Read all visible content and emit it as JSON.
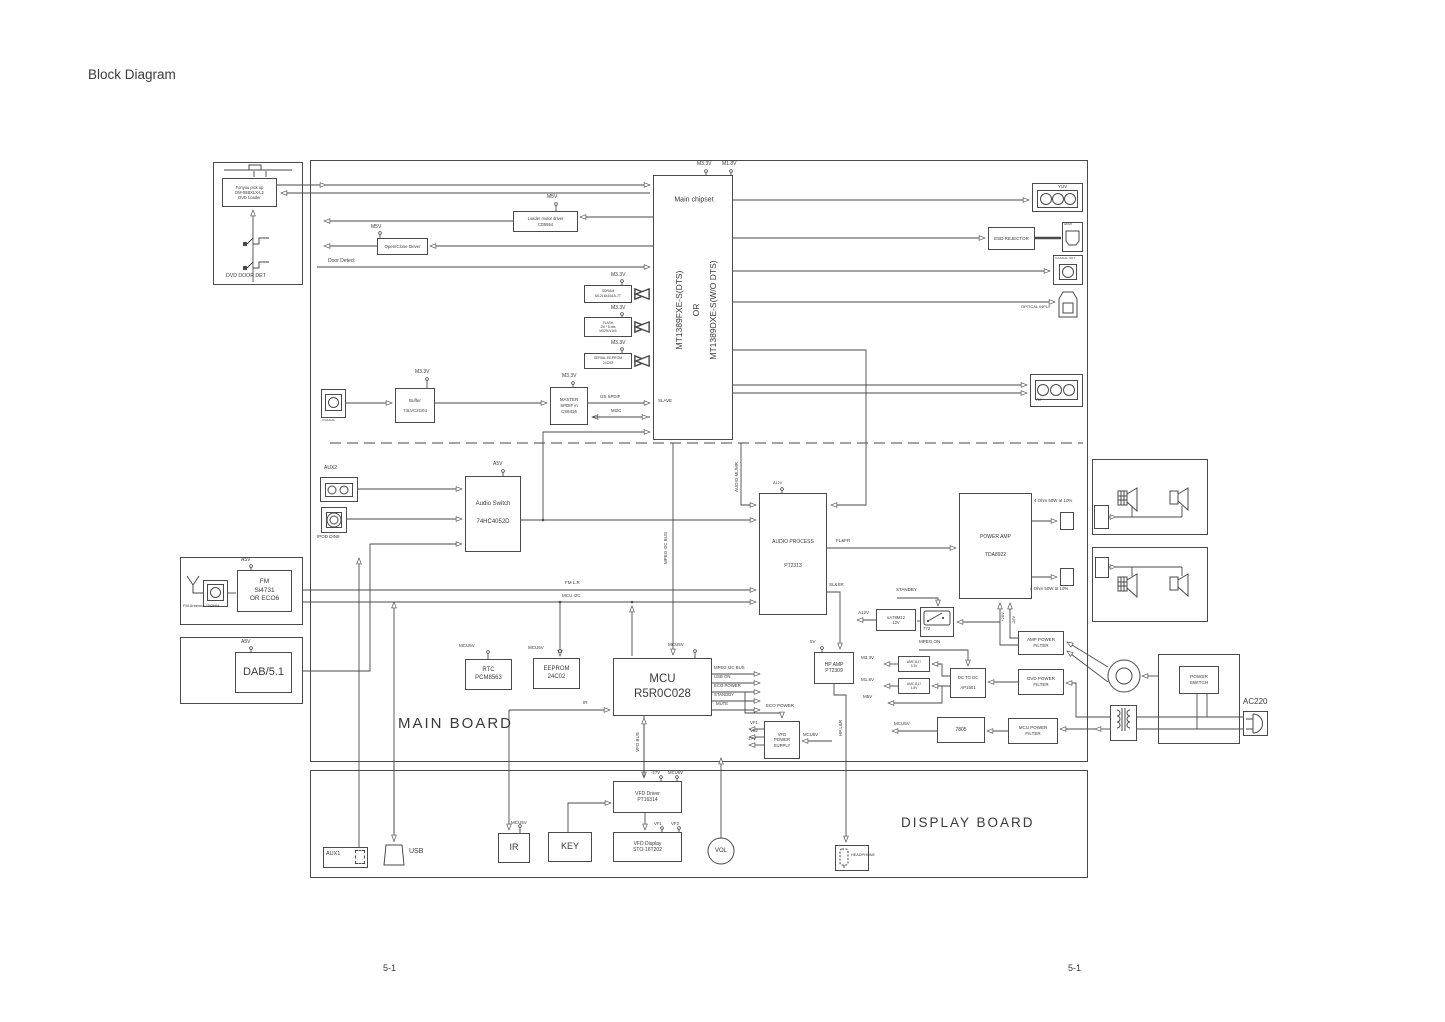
{
  "page": {
    "title": "Block Diagram",
    "footer_left": "5-1",
    "footer_right": "5-1"
  },
  "outlines": [
    {
      "n": "dvd-loader-assembly",
      "x": 213,
      "y": 162,
      "w": 90,
      "h": 123
    },
    {
      "n": "main-board",
      "x": 310,
      "y": 160,
      "w": 778,
      "h": 602
    },
    {
      "n": "display-board",
      "x": 310,
      "y": 770,
      "w": 778,
      "h": 108
    },
    {
      "n": "main-chipset-box",
      "x": 653,
      "y": 175,
      "w": 80,
      "h": 265
    },
    {
      "n": "fm-module-box",
      "x": 180,
      "y": 557,
      "w": 123,
      "h": 68
    },
    {
      "n": "dab-module-box",
      "x": 180,
      "y": 637,
      "w": 123,
      "h": 67
    },
    {
      "n": "speaker-box-1",
      "x": 1092,
      "y": 459,
      "w": 116,
      "h": 76
    },
    {
      "n": "speaker-box-2",
      "x": 1092,
      "y": 547,
      "w": 116,
      "h": 75
    },
    {
      "n": "power-supply-box",
      "x": 1158,
      "y": 654,
      "w": 82,
      "h": 90
    },
    {
      "n": "relay-772-box",
      "x": 920,
      "y": 607,
      "w": 34,
      "h": 30
    },
    {
      "n": "yuv-connector",
      "x": 1032,
      "y": 183,
      "w": 51,
      "h": 29
    },
    {
      "n": "yuv-connector-inner",
      "x": 1037,
      "y": 190,
      "w": 41,
      "h": 18
    },
    {
      "n": "av-connector",
      "x": 1030,
      "y": 374,
      "w": 53,
      "h": 33
    },
    {
      "n": "av-connector-inner",
      "x": 1035,
      "y": 380,
      "w": 43,
      "h": 20
    },
    {
      "n": "aux2-connector",
      "x": 320,
      "y": 477,
      "w": 38,
      "h": 25
    },
    {
      "n": "aux2-connector-inner",
      "x": 325,
      "y": 483,
      "w": 28,
      "h": 14
    },
    {
      "n": "ipod-connector",
      "x": 321,
      "y": 507,
      "w": 26,
      "h": 26
    },
    {
      "n": "ipod-connector-inner",
      "x": 326,
      "y": 512,
      "w": 16,
      "h": 16
    },
    {
      "n": "coaxial-in-connector",
      "x": 321,
      "y": 389,
      "w": 25,
      "h": 29
    },
    {
      "n": "coaxial-in-inner",
      "x": 325,
      "y": 394,
      "w": 17,
      "h": 17
    },
    {
      "n": "fm-antenna-connector",
      "x": 203,
      "y": 580,
      "w": 25,
      "h": 27
    },
    {
      "n": "fm-antenna-inner",
      "x": 207,
      "y": 584,
      "w": 17,
      "h": 17
    },
    {
      "n": "coaxial-out-connector",
      "x": 1053,
      "y": 255,
      "w": 30,
      "h": 30
    },
    {
      "n": "coaxial-out-inner",
      "x": 1059,
      "y": 264,
      "w": 18,
      "h": 16
    },
    {
      "n": "hdmi-connector",
      "x": 1062,
      "y": 222,
      "w": 21,
      "h": 30
    },
    {
      "n": "speaker-terminal-top",
      "x": 1060,
      "y": 512,
      "w": 14,
      "h": 18
    },
    {
      "n": "speaker-terminal-bottom",
      "x": 1060,
      "y": 568,
      "w": 14,
      "h": 18
    },
    {
      "n": "speaker-conn-1",
      "x": 1094,
      "y": 505,
      "w": 15,
      "h": 24
    },
    {
      "n": "speaker-conn-2",
      "x": 1095,
      "y": 557,
      "w": 14,
      "h": 21
    },
    {
      "n": "aux1-connector",
      "x": 323,
      "y": 847,
      "w": 45,
      "h": 21
    },
    {
      "n": "aux1-inner",
      "x": 355,
      "y": 850,
      "w": 10,
      "h": 14,
      "d": 1
    },
    {
      "n": "headphone-connector",
      "x": 835,
      "y": 845,
      "w": 34,
      "h": 26
    },
    {
      "n": "transformer-box",
      "x": 1110,
      "y": 705,
      "w": 27,
      "h": 36
    },
    {
      "n": "ac-plug-box",
      "x": 1243,
      "y": 711,
      "w": 25,
      "h": 25
    }
  ],
  "blocks": [
    {
      "n": "dvd-loader",
      "x": 222,
      "y": 178,
      "w": 55,
      "h": 29,
      "fs": 4.1,
      "ls": [
        "Fonyou pick up",
        "DM-06BXLX-L2",
        "DVD Loader"
      ]
    },
    {
      "n": "loader-motor-driver",
      "x": 513,
      "y": 211,
      "w": 65,
      "h": 21,
      "fs": 4.1,
      "ls": [
        "Loader motor driver",
        "CD5954"
      ]
    },
    {
      "n": "open-close-driver",
      "x": 377,
      "y": 238,
      "w": 51,
      "h": 17,
      "fs": 4.4,
      "ls": [
        "Open/Close Driver"
      ]
    },
    {
      "n": "sdram",
      "x": 584,
      "y": 285,
      "w": 48,
      "h": 18,
      "fs": 3.5,
      "ls": [
        "SDRAM",
        "M12L64164A-7T"
      ]
    },
    {
      "n": "flash",
      "x": 584,
      "y": 317,
      "w": 48,
      "h": 20,
      "fs": 3.2,
      "ls": [
        "FLASH",
        "2M * 8 bits",
        "MX29LV160"
      ]
    },
    {
      "n": "serial-eeprom",
      "x": 584,
      "y": 353,
      "w": 48,
      "h": 16,
      "fs": 3.5,
      "ls": [
        "SERIAL EEPROM",
        "24C02"
      ]
    },
    {
      "n": "master-spdif",
      "x": 550,
      "y": 387,
      "w": 38,
      "h": 38,
      "fs": 4.4,
      "ls": [
        "MASTER",
        "SPDIF in",
        "CS8416"
      ]
    },
    {
      "n": "buffer",
      "x": 395,
      "y": 388,
      "w": 40,
      "h": 35,
      "fs": 4.4,
      "g": 4,
      "ls": [
        "Buffer",
        "74LVC2G04"
      ]
    },
    {
      "n": "audio-switch",
      "x": 465,
      "y": 476,
      "w": 56,
      "h": 76,
      "fs": 6,
      "g": 10,
      "ls": [
        "Audio Switch",
        "74HC4052D"
      ]
    },
    {
      "n": "audio-process",
      "x": 759,
      "y": 493,
      "w": 68,
      "h": 122,
      "fs": 5,
      "g": 18,
      "ls": [
        "AUDIO PROCESS",
        "PT2313"
      ]
    },
    {
      "n": "power-amp",
      "x": 959,
      "y": 493,
      "w": 73,
      "h": 106,
      "fs": 5,
      "g": 12,
      "ls": [
        "POWER AMP",
        "TDA8922"
      ]
    },
    {
      "n": "fm-tuner",
      "x": 237,
      "y": 570,
      "w": 55,
      "h": 42,
      "fs": 6.5,
      "ls": [
        "FM",
        "Si4731",
        "OR ECO6"
      ]
    },
    {
      "n": "dab-module",
      "x": 235,
      "y": 652,
      "w": 57,
      "h": 41,
      "fs": 11,
      "ls": [
        "DAB/5.1"
      ]
    },
    {
      "n": "rtc",
      "x": 465,
      "y": 659,
      "w": 47,
      "h": 31,
      "fs": 6,
      "ls": [
        "RTC",
        "PCM8563"
      ]
    },
    {
      "n": "eeprom",
      "x": 533,
      "y": 658,
      "w": 47,
      "h": 31,
      "fs": 6,
      "ls": [
        "EEPROM",
        "24C02"
      ]
    },
    {
      "n": "mcu",
      "x": 613,
      "y": 658,
      "w": 99,
      "h": 58,
      "fs": 11.5,
      "ls": [
        "MCU",
        "R5R0C028"
      ]
    },
    {
      "n": "hp-amp",
      "x": 814,
      "y": 652,
      "w": 40,
      "h": 32,
      "fs": 5,
      "ls": [
        "HP AMP",
        "PT2309"
      ]
    },
    {
      "n": "ua78m12",
      "x": 876,
      "y": 609,
      "w": 40,
      "h": 22,
      "fs": 4.2,
      "ls": [
        "uA78M12",
        "12V"
      ]
    },
    {
      "n": "amc1117-33",
      "x": 898,
      "y": 656,
      "w": 32,
      "h": 16,
      "fs": 3.3,
      "ls": [
        "AMC1117",
        "3.3V"
      ]
    },
    {
      "n": "amc1117-18",
      "x": 898,
      "y": 678,
      "w": 32,
      "h": 16,
      "fs": 3.3,
      "ls": [
        "AMC1117",
        "1.8V"
      ]
    },
    {
      "n": "dc-to-dc",
      "x": 950,
      "y": 668,
      "w": 36,
      "h": 30,
      "fs": 4.3,
      "g": 4,
      "ls": [
        "DC TO DC",
        "AP1501"
      ]
    },
    {
      "n": "dvd-power-filter",
      "x": 1018,
      "y": 669,
      "w": 46,
      "h": 26,
      "fs": 4.5,
      "ls": [
        "DVD POWER",
        "FILTER"
      ]
    },
    {
      "n": "amp-power-filter",
      "x": 1018,
      "y": 631,
      "w": 46,
      "h": 24,
      "fs": 4.5,
      "ls": [
        "AMP POWER",
        "FILTER"
      ]
    },
    {
      "n": "mcu-power-filter",
      "x": 1008,
      "y": 718,
      "w": 50,
      "h": 26,
      "fs": 4.5,
      "ls": [
        "MCU POWER",
        "FILTER"
      ]
    },
    {
      "n": "reg-7805",
      "x": 937,
      "y": 717,
      "w": 48,
      "h": 26,
      "fs": 5,
      "ls": [
        "7805"
      ]
    },
    {
      "n": "vfd-power-supply",
      "x": 764,
      "y": 721,
      "w": 36,
      "h": 38,
      "fs": 4.3,
      "ls": [
        "VFD",
        "POWER",
        "SUPPLY"
      ]
    },
    {
      "n": "esd-rejector",
      "x": 988,
      "y": 227,
      "w": 47,
      "h": 23,
      "fs": 4.5,
      "ls": [
        "ESD REJECTOR"
      ]
    },
    {
      "n": "power-switch",
      "x": 1179,
      "y": 666,
      "w": 40,
      "h": 28,
      "fs": 4.7,
      "ls": [
        "POWER",
        "SWITCH"
      ]
    },
    {
      "n": "vfd-driver",
      "x": 613,
      "y": 781,
      "w": 69,
      "h": 32,
      "fs": 5,
      "ls": [
        "VFD Driver",
        "PT16314"
      ]
    },
    {
      "n": "vfd-display",
      "x": 613,
      "y": 832,
      "w": 69,
      "h": 30,
      "fs": 5,
      "ls": [
        "VFD Display",
        "STO-16T202"
      ]
    },
    {
      "n": "ir-receiver",
      "x": 498,
      "y": 833,
      "w": 32,
      "h": 30,
      "fs": 9,
      "ls": [
        "IR"
      ]
    },
    {
      "n": "key-block",
      "x": 548,
      "y": 832,
      "w": 44,
      "h": 30,
      "fs": 9,
      "ls": [
        "KEY"
      ]
    }
  ],
  "labels": [
    {
      "n": "page-title",
      "x": 88,
      "y": 68,
      "fs": 13.5,
      "t": "Block Diagram"
    },
    {
      "n": "footer-left",
      "x": 383,
      "y": 964,
      "fs": 9,
      "t": "5-1"
    },
    {
      "n": "footer-right",
      "x": 1068,
      "y": 964,
      "fs": 9,
      "t": "5-1"
    },
    {
      "n": "main-board-label",
      "x": 398,
      "y": 716,
      "fs": 15,
      "t": "MAIN BOARD",
      "sp": 2
    },
    {
      "n": "display-board-label",
      "x": 901,
      "y": 816,
      "fs": 13.5,
      "t": "DISPLAY BOARD",
      "sp": 2
    },
    {
      "n": "chipset-title",
      "x": 694,
      "y": 200,
      "fs": 7,
      "t": "Main chipset",
      "c": 1
    },
    {
      "n": "chipset-model-a",
      "x": 679,
      "y": 310,
      "fs": 8.5,
      "t": "MT1389FXE-S(DTS)",
      "r": 1
    },
    {
      "n": "chipset-or",
      "x": 696,
      "y": 310,
      "fs": 8.5,
      "t": "OR",
      "r": 1
    },
    {
      "n": "chipset-model-b",
      "x": 713,
      "y": 310,
      "fs": 8.5,
      "t": "MT1389DXE-S(W/O DTS)",
      "r": 1
    },
    {
      "n": "slave",
      "x": 658,
      "y": 399,
      "fs": 4.5,
      "t": "SLAVE"
    },
    {
      "n": "m33-chipset",
      "x": 697,
      "y": 162,
      "fs": 5,
      "t": "M3.3V"
    },
    {
      "n": "m18-chipset",
      "x": 722,
      "y": 162,
      "fs": 5,
      "t": "M1.8V"
    },
    {
      "n": "dvd-door-det",
      "x": 226,
      "y": 274,
      "fs": 5.2,
      "t": "DVD DOOR DET"
    },
    {
      "n": "m5v-loader-driver",
      "x": 547,
      "y": 195,
      "fs": 5,
      "t": "M5V"
    },
    {
      "n": "m5v-open-close",
      "x": 371,
      "y": 225,
      "fs": 5,
      "t": "M5V"
    },
    {
      "n": "door-detect",
      "x": 328,
      "y": 259,
      "fs": 5,
      "t": "Door Detect"
    },
    {
      "n": "m33-sdram",
      "x": 611,
      "y": 273,
      "fs": 5,
      "t": "M3.3V"
    },
    {
      "n": "m33-flash",
      "x": 611,
      "y": 306,
      "fs": 5,
      "t": "M3.3V"
    },
    {
      "n": "m33-serial",
      "x": 611,
      "y": 341,
      "fs": 5,
      "t": "M3.3V"
    },
    {
      "n": "m33-spdif",
      "x": 562,
      "y": 374,
      "fs": 5,
      "t": "M3.3V"
    },
    {
      "n": "m33-buffer",
      "x": 415,
      "y": 370,
      "fs": 5,
      "t": "M3.3V"
    },
    {
      "n": "i2s-spdif",
      "x": 600,
      "y": 395,
      "fs": 4.3,
      "t": "I2S SPDIF"
    },
    {
      "n": "mi2c",
      "x": 611,
      "y": 409,
      "fs": 4.3,
      "t": "MI2C"
    },
    {
      "n": "coaxial-in-label",
      "x": 322,
      "y": 419,
      "fs": 3,
      "t": "COAXIAL"
    },
    {
      "n": "yuv-label",
      "x": 1058,
      "y": 185,
      "fs": 4.5,
      "t": "YUV"
    },
    {
      "n": "hdmi-label",
      "x": 1064,
      "y": 223,
      "fs": 3,
      "t": "HDMI"
    },
    {
      "n": "coaxial-out-label",
      "x": 1055,
      "y": 257,
      "fs": 3,
      "t": "COAXIAL OUT"
    },
    {
      "n": "optical-input-label",
      "x": 1021,
      "y": 305,
      "fs": 4,
      "t": "OPTICAL INPUT"
    },
    {
      "n": "av-label",
      "x": 1036,
      "y": 398,
      "fs": 4.3,
      "t": "AV"
    },
    {
      "n": "aux2-label",
      "x": 324,
      "y": 466,
      "fs": 5,
      "t": "AUX2"
    },
    {
      "n": "ipod-label",
      "x": 317,
      "y": 535,
      "fs": 4.5,
      "t": "IPOD DIN9"
    },
    {
      "n": "a5v-switch",
      "x": 493,
      "y": 462,
      "fs": 5,
      "t": "A5V"
    },
    {
      "n": "a5v-fm",
      "x": 241,
      "y": 558,
      "fs": 5,
      "t": "A5V"
    },
    {
      "n": "fm-antenna-label",
      "x": 183,
      "y": 604,
      "fs": 4,
      "t": "FM Antenna 75OHM"
    },
    {
      "n": "a5v-dab",
      "x": 241,
      "y": 640,
      "fs": 5,
      "t": "A5V"
    },
    {
      "n": "audio-ml-mr",
      "x": 737,
      "y": 477,
      "fs": 4.5,
      "t": "AUDIO ML/MR",
      "r": 1
    },
    {
      "n": "a12v-process",
      "x": 773,
      "y": 482,
      "fs": 3.8,
      "t": "A12V"
    },
    {
      "n": "mpeg-i2c-vert",
      "x": 666,
      "y": 548,
      "fs": 4.5,
      "t": "MPEG I2C BUS",
      "r": 1
    },
    {
      "n": "fm-lr",
      "x": 565,
      "y": 581,
      "fs": 4.5,
      "t": "FM L.R"
    },
    {
      "n": "mcu-i2c",
      "x": 562,
      "y": 594,
      "fs": 4.5,
      "t": "MCU I2C"
    },
    {
      "n": "flfr",
      "x": 836,
      "y": 539,
      "fs": 4.5,
      "t": "FL&FR"
    },
    {
      "n": "slsr",
      "x": 829,
      "y": 583,
      "fs": 4.5,
      "t": "SL&SR"
    },
    {
      "n": "ohm-top",
      "x": 1034,
      "y": 499,
      "fs": 4.4,
      "t": "4 Ohm 50W at 10%"
    },
    {
      "n": "ohm-bottom",
      "x": 1030,
      "y": 587,
      "fs": 4.4,
      "t": "4 Ohm 50W at 10%"
    },
    {
      "n": "standby-772",
      "x": 896,
      "y": 588,
      "fs": 4.5,
      "t": "STANDBY"
    },
    {
      "n": "a12v-reg",
      "x": 858,
      "y": 611,
      "fs": 4.5,
      "t": "A12V"
    },
    {
      "n": "plus-26v",
      "x": 1004,
      "y": 617,
      "fs": 3.8,
      "t": "+26V",
      "r": 1
    },
    {
      "n": "minus-26v",
      "x": 1015,
      "y": 620,
      "fs": 3.8,
      "t": "-26V",
      "r": 1
    },
    {
      "n": "mpeg-on",
      "x": 919,
      "y": 640,
      "fs": 4.5,
      "t": "MPEG ON"
    },
    {
      "n": "m33-amc",
      "x": 861,
      "y": 656,
      "fs": 4.5,
      "t": "M3.3V"
    },
    {
      "n": "m18-amc",
      "x": 861,
      "y": 678,
      "fs": 4.5,
      "t": "M1.8V"
    },
    {
      "n": "m5v-dcdc",
      "x": 863,
      "y": 695,
      "fs": 4.5,
      "t": "M5V"
    },
    {
      "n": "mcu5v-rtc",
      "x": 459,
      "y": 644,
      "fs": 4.5,
      "t": "MCU5V"
    },
    {
      "n": "mcu5v-eeprom",
      "x": 528,
      "y": 646,
      "fs": 4.5,
      "t": "MCU5V"
    },
    {
      "n": "mcu5v-mcu",
      "x": 668,
      "y": 643,
      "fs": 4.5,
      "t": "MCU5V"
    },
    {
      "n": "out-mpeg-i2c",
      "x": 714,
      "y": 666,
      "fs": 4.3,
      "t": "MPEG I2C BUS"
    },
    {
      "n": "out-usb-on",
      "x": 714,
      "y": 675,
      "fs": 4.3,
      "t": "USB ON"
    },
    {
      "n": "out-eco-power",
      "x": 714,
      "y": 684,
      "fs": 4.3,
      "t": "ECO POWER"
    },
    {
      "n": "out-standby",
      "x": 714,
      "y": 693,
      "fs": 4.3,
      "t": "STANDBY"
    },
    {
      "n": "out-mute",
      "x": 716,
      "y": 702,
      "fs": 4.3,
      "t": "MUTE"
    },
    {
      "n": "ir-signal",
      "x": 583,
      "y": 701,
      "fs": 4.5,
      "t": "IR"
    },
    {
      "n": "vfd-bus",
      "x": 638,
      "y": 742,
      "fs": 4.5,
      "t": "VFD BUS",
      "r": 1
    },
    {
      "n": "eco-power-supply",
      "x": 766,
      "y": 704,
      "fs": 4.5,
      "t": "ECO POWER"
    },
    {
      "n": "vf1",
      "x": 750,
      "y": 721,
      "fs": 4.3,
      "t": "VF1"
    },
    {
      "n": "vf2",
      "x": 750,
      "y": 729,
      "fs": 4.3,
      "t": "VF2"
    },
    {
      "n": "minus27",
      "x": 747,
      "y": 737,
      "fs": 4.3,
      "t": "-27V"
    },
    {
      "n": "mcu5v-supply",
      "x": 803,
      "y": 733,
      "fs": 4.3,
      "t": "MCU5V"
    },
    {
      "n": "hp-lr",
      "x": 841,
      "y": 728,
      "fs": 4.5,
      "t": "HP L&R",
      "r": 1
    },
    {
      "n": "v5-hpamp",
      "x": 810,
      "y": 640,
      "fs": 4.5,
      "t": "5V"
    },
    {
      "n": "mcu5v-7805",
      "x": 894,
      "y": 722,
      "fs": 4.5,
      "t": "MCU5V"
    },
    {
      "n": "relay-772-label",
      "x": 923,
      "y": 627,
      "fs": 4.3,
      "t": "772"
    },
    {
      "n": "ac220-label",
      "x": 1243,
      "y": 698,
      "fs": 8,
      "t": "AC220"
    },
    {
      "n": "mcu5v-ir",
      "x": 511,
      "y": 821,
      "fs": 4.5,
      "t": "MCU5V"
    },
    {
      "n": "minus27-driver",
      "x": 651,
      "y": 771,
      "fs": 4.3,
      "t": "-27V"
    },
    {
      "n": "mcu5v-driver",
      "x": 668,
      "y": 771,
      "fs": 4.3,
      "t": "MCU5V"
    },
    {
      "n": "vf1-display",
      "x": 654,
      "y": 822,
      "fs": 4.3,
      "t": "VF1"
    },
    {
      "n": "vf2-display",
      "x": 671,
      "y": 822,
      "fs": 4.3,
      "t": "VF2"
    },
    {
      "n": "usb-label",
      "x": 409,
      "y": 848,
      "fs": 7,
      "t": "USB"
    },
    {
      "n": "aux1-label",
      "x": 326,
      "y": 852,
      "fs": 5.5,
      "t": "AUX1"
    },
    {
      "n": "headphone-label",
      "x": 851,
      "y": 854,
      "fs": 3.8,
      "t": "HEADPHONE"
    },
    {
      "n": "vol-label",
      "x": 721,
      "y": 851,
      "fs": 6,
      "t": "VOL",
      "c": 1
    }
  ]
}
